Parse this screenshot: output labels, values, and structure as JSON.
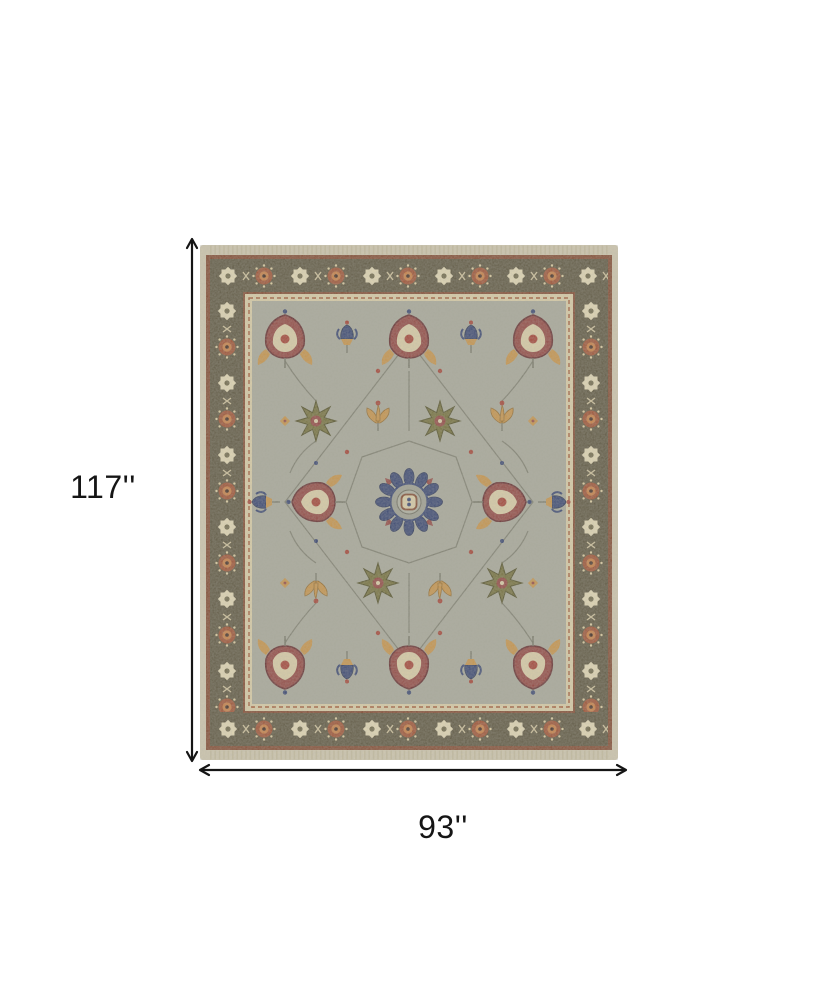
{
  "canvas": {
    "background": "#ffffff"
  },
  "product_image": {
    "name": "oriental-area-rug",
    "description": "Traditional oriental area rug with gray-green field, allover multicolor floral motifs, central rosette medallion, dark olive star-and-rosette border and tan fringe",
    "colors": {
      "fringe": "#d2cab1",
      "guard_red": "#7e432a",
      "border_olive": "#57503a",
      "border_cream": "#e6dbb6",
      "field": "#a7a89a",
      "vine": "#6f7061",
      "navy": "#2f3e6e",
      "maroon": "#8f3f3b",
      "gold": "#c89143",
      "cream": "#ddd0a8",
      "olive": "#6f6b35",
      "accent_red": "#a33b2e",
      "rosette_red": "#9c4a2b"
    }
  },
  "dimensions": {
    "height_label": "117''",
    "width_label": "93''",
    "line_color": "#151515"
  }
}
